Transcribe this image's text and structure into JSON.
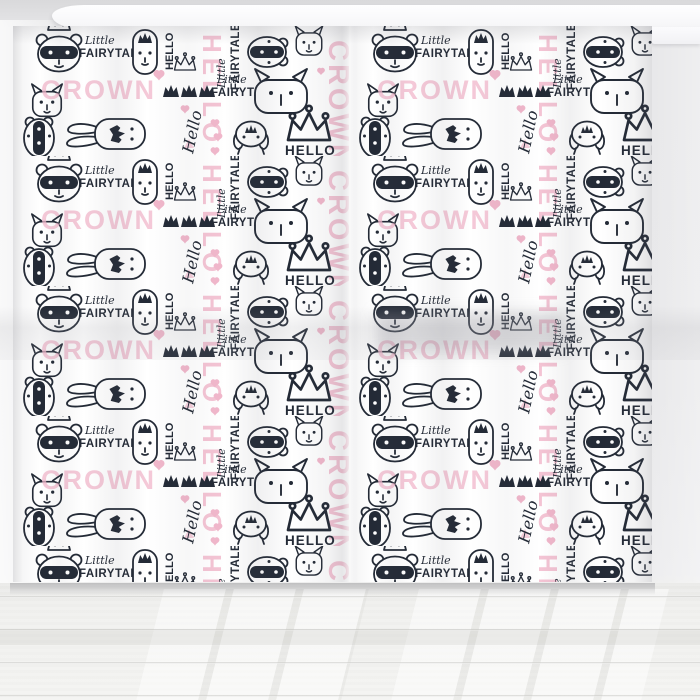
{
  "photo": {
    "subject": "kids curtain panels hanging in a room",
    "room": {
      "wall_color": "#e7e7e9",
      "floor_color": "#f1f1ef",
      "cornice_color": "#fbfbfd"
    },
    "curtain": {
      "panels": 2,
      "fabric_background": "#ffffff"
    }
  },
  "pattern": {
    "ink_color": "#232a36",
    "pink_color": "#f1b7cb",
    "pink_soft_color": "#f6cfdc",
    "words": {
      "crown": "CROWN",
      "hello_caps": "HELLO",
      "hello_script": "Hello",
      "little": "Little",
      "fairytale": "FAIRYTALE"
    },
    "motifs": [
      "raccoon-with-crown",
      "tall-bunny-with-crown",
      "sideways-bunny-with-crown",
      "trapper-hat-bunny",
      "badger-face",
      "cat-face",
      "big-cat-head",
      "outline-crown",
      "filled-crown",
      "pink-heart",
      "pink-triangle"
    ]
  }
}
